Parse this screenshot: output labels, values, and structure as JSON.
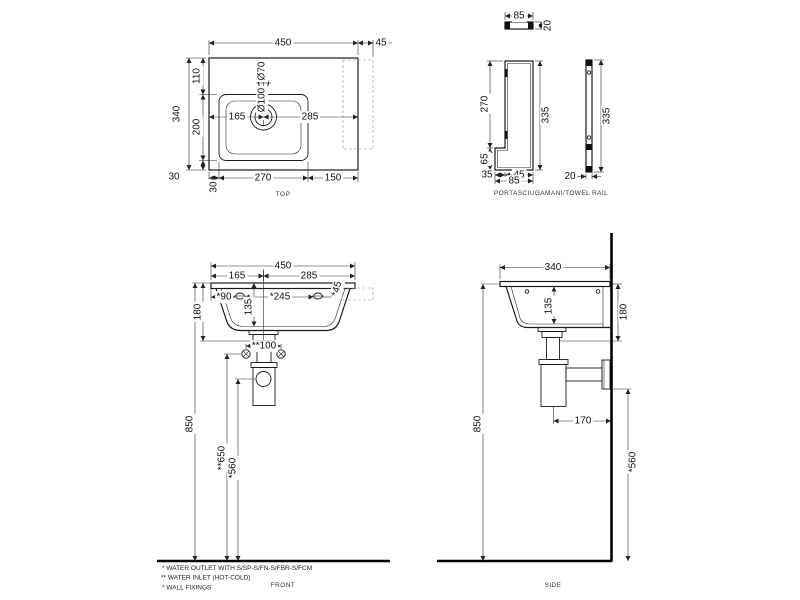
{
  "drawing": {
    "top_view": {
      "caption": "TOP",
      "dims": {
        "width": "450",
        "rail_overhang": "45",
        "depth": "340",
        "rear_offset": "110",
        "bowl_depth": "200",
        "front_inset": "30",
        "left_inset": "30",
        "bowl_width": "270",
        "right_deck": "150",
        "center_left": "165",
        "center_right": "285",
        "faucet_dia": "Ø70",
        "drain_dia": "Ø100"
      }
    },
    "towel_rail": {
      "caption": "PORTASCIUGAMANI/TOWEL RAIL",
      "dims": {
        "top_width": "85",
        "top_depth": "20",
        "front_upper": "270",
        "front_lower": "65",
        "front_total": "335",
        "bottom_a": "35",
        "bottom_b": "45",
        "bottom_total": "85",
        "side_height": "335",
        "side_thickness": "20"
      }
    },
    "front_view": {
      "caption": "FRONT",
      "dims": {
        "width": "450",
        "center_left": "165",
        "center_right": "285",
        "fix_left": "*90",
        "fix_mid": "*245",
        "fix_right": "*45",
        "height": "180",
        "bowl_inner": "135",
        "inlet_gap": "**100",
        "rim_height": "850",
        "inlet_height": "**650",
        "outlet_height": "*560"
      }
    },
    "side_view": {
      "caption": "SIDE",
      "dims": {
        "depth": "340",
        "bowl_inner": "135",
        "height": "180",
        "trap_wall": "170",
        "rim_height": "850",
        "outlet_height": "*560"
      }
    },
    "notes": {
      "outlet": "*  WATER OUTLET WITH S/SP-S/FN-S/FBR-S/FCM",
      "inlet": "** WATER INLET  (HOT-COLD)",
      "fixings": "*  WALL FIXINGS"
    }
  }
}
